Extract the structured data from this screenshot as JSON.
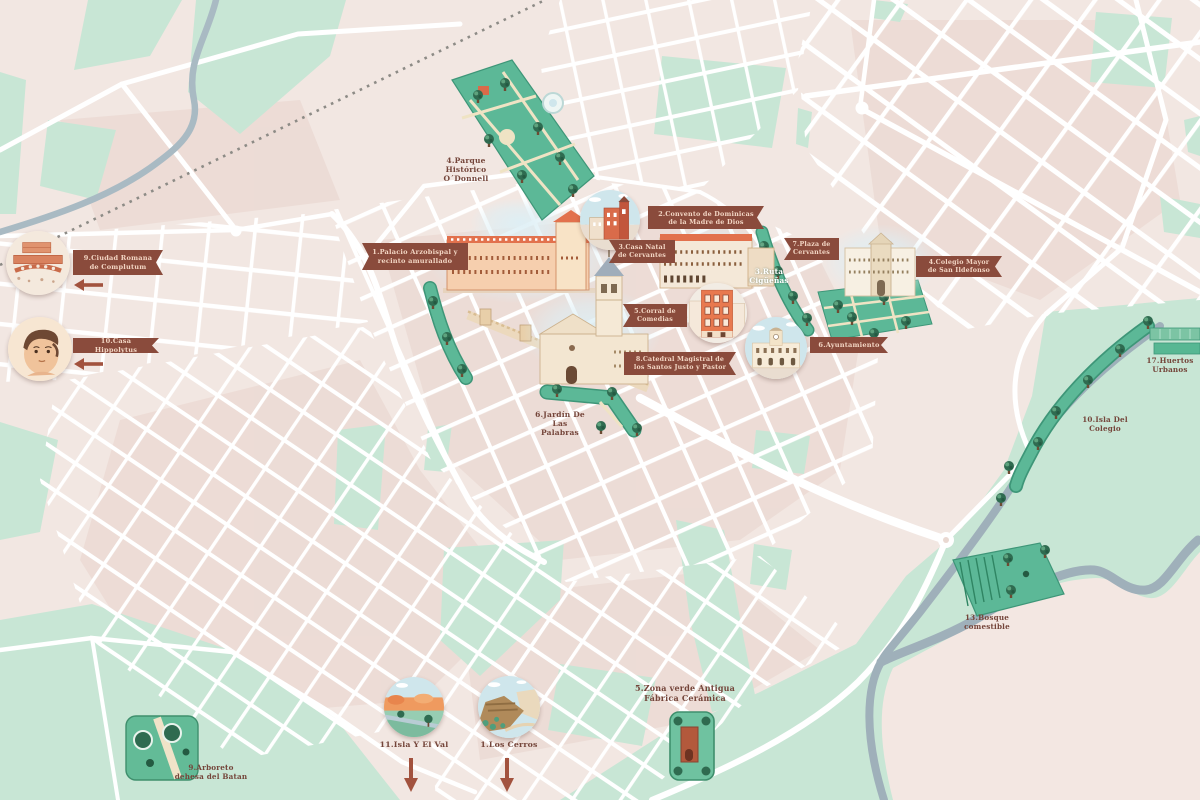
{
  "map_name": "illustrated-city-tourist-map",
  "colors": {
    "background": "#f2e7e2",
    "block": "#ecdbd4",
    "street": "#ffffff",
    "green_light": "#c8e6d5",
    "green_park": "#5cb897",
    "green_border": "#3e9678",
    "tree": "#2f6b50",
    "river": "#9fb0ba",
    "stream": "#a9bac3",
    "railway": "#8d8b86",
    "ribbon": "#8a4b3c",
    "ribbon_text": "#f3d6c4",
    "label_text": "#74453a",
    "building_orange": "#e2714d",
    "building_cream": "#f4e8d8"
  },
  "ribbons": [
    {
      "id": "palacio-arzobispal",
      "label": "1.Palacio Arzobispal y recinto amurallado"
    },
    {
      "id": "convento-dominicas",
      "label": "2.Convento de Dominicas de la Madre de Dios"
    },
    {
      "id": "casa-natal-cervantes",
      "label": "3.Casa Natal de Cervantes"
    },
    {
      "id": "corral-comedias",
      "label": "5.Corral de Comedias"
    },
    {
      "id": "catedral-magistral",
      "label": "8.Catedral Magistral de los Santos Justo y Pastor"
    },
    {
      "id": "ayuntamiento",
      "label": "6.Ayuntamiento"
    },
    {
      "id": "plaza-cervantes",
      "label": "7.Plaza de Cervantes"
    },
    {
      "id": "colegio-mayor",
      "label": "4.Colegio Mayor de San Ildefonso"
    },
    {
      "id": "ciudad-romana",
      "label": "9.Ciudad Romana de Complutum"
    },
    {
      "id": "casa-hippolytus",
      "label": "10.Casa Hippolytus"
    }
  ],
  "area_labels": [
    {
      "id": "parque-odonnell",
      "label": "4.Parque Histórico O´Donnell"
    },
    {
      "id": "jardin-palabras",
      "label": "6.Jardín De Las Palabras"
    },
    {
      "id": "ruta-ciguenas",
      "label": "3.Ruta Cigüeñas"
    },
    {
      "id": "zona-verde-fabrica",
      "label": "5.Zona verde Antigua Fábrica Cerámica"
    },
    {
      "id": "isla-el-val",
      "label": "11.Isla Y El Val"
    },
    {
      "id": "los-cerros",
      "label": "1.Los Cerros"
    },
    {
      "id": "arboreto-batan",
      "label": "9.Arboreto dehesa del Batan"
    },
    {
      "id": "bosque-comestible",
      "label": "13.Bosque comestible"
    },
    {
      "id": "isla-colegio",
      "label": "10.Isla Del Colegio"
    },
    {
      "id": "huertos-urbanos",
      "label": "17.Huertos Urbanos"
    }
  ],
  "icons": {
    "ciudad_romana": "roman-ruins-illustration",
    "casa_hippolytus": "mosaic-face-illustration",
    "convento": "convent-building-illustration",
    "corral": "theatre-facade-illustration",
    "ayuntamiento": "town-hall-illustration",
    "isla_el_val": "river-park-landscape-illustration",
    "los_cerros": "hills-landscape-illustration",
    "fabrica_ceramica": "ceramic-factory-kiln-illustration"
  }
}
